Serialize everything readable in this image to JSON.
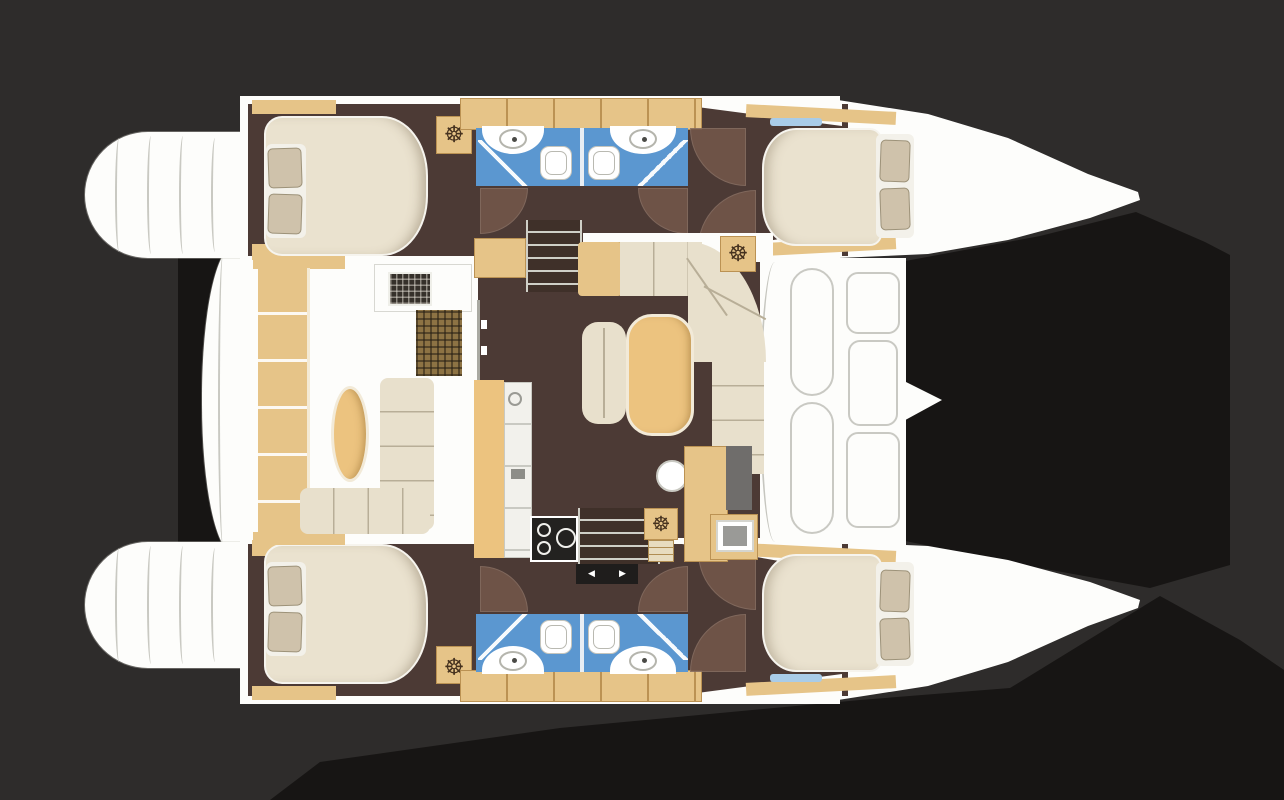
{
  "palette": {
    "bg": "#2e2c2b",
    "shadow": "#171514",
    "hull": "#fdfdfb",
    "hullLine": "#c6c6bf",
    "floor": "#4c3a35",
    "floorDark": "#41312c",
    "arc": "#72564a",
    "tan": "#e6c488",
    "tanDeep": "#ecc37f",
    "tanLine": "#bb9253",
    "cream": "#e8e0cc",
    "creamLine": "#b8ae97",
    "bedCream": "#eae2cf",
    "pillow": "#cfc2ab",
    "bath": "#5b97d0",
    "stove": "#232220",
    "grayPanel": "#6f6d6b",
    "screen": "#e9e9e7",
    "stair": "#3f3029",
    "stairLine": "#cfcfc7",
    "blueWindow": "#a9cce8"
  },
  "icons": {
    "wheel": "☸",
    "arrow_left": "◀",
    "arrow_right": "▶"
  }
}
